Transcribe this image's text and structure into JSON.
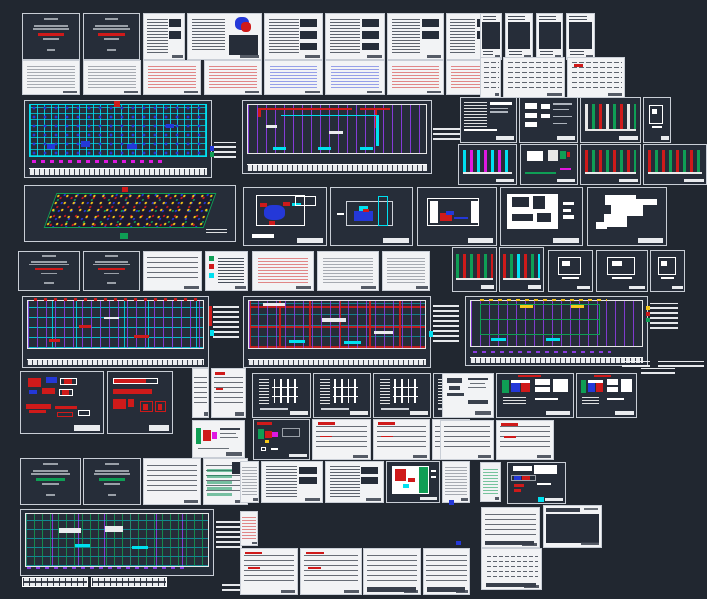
{
  "app": {
    "name": "cad-model-space",
    "canvas": {
      "width": 707,
      "height": 599
    }
  },
  "palette": {
    "bg": "#212730",
    "sheetdark": "#262d39",
    "paper": "#f2f3f5",
    "ink": "#39404c",
    "gray": "#9aa0a8",
    "red": "#cf1a1a",
    "green": "#0f9e55",
    "cyan": "#00e0f0",
    "blue": "#2438d8",
    "purple": "#8a3ce0",
    "magenta": "#e018e0",
    "yellow": "#f5c71a",
    "white": "#ffffff"
  },
  "tints": {
    "gray": "rgba(90,97,110,0.5)",
    "red": "rgba(207,26,26,0.5)",
    "blue": "rgba(36,56,216,0.45)",
    "green": "rgba(15,158,85,0.55)"
  },
  "sheets": [
    {
      "id": "cover-1",
      "x": 22,
      "y": 13,
      "w": 58,
      "h": 47,
      "type": "cover",
      "accent": "red"
    },
    {
      "id": "cover-2",
      "x": 83,
      "y": 13,
      "w": 57,
      "h": 47,
      "type": "cover",
      "accent": "red"
    },
    {
      "id": "notes-1",
      "x": 143,
      "y": 13,
      "w": 42,
      "h": 47,
      "type": "notes",
      "blocks": 2
    },
    {
      "id": "logo-sheet",
      "x": 187,
      "y": 13,
      "w": 75,
      "h": 47,
      "type": "logo"
    },
    {
      "id": "notes-2",
      "x": 264,
      "y": 13,
      "w": 59,
      "h": 47,
      "type": "notes",
      "blocks": 3
    },
    {
      "id": "notes-3",
      "x": 325,
      "y": 13,
      "w": 60,
      "h": 47,
      "type": "notes",
      "blocks": 3
    },
    {
      "id": "notes-4",
      "x": 387,
      "y": 13,
      "w": 57,
      "h": 47,
      "type": "notes",
      "blocks": 2
    },
    {
      "id": "notes-5",
      "x": 446,
      "y": 13,
      "w": 50,
      "h": 47,
      "type": "notes",
      "blocks": 2
    },
    {
      "id": "sched-1",
      "x": 480,
      "y": 13,
      "w": 22,
      "h": 47,
      "type": "narrowdark"
    },
    {
      "id": "sched-2",
      "x": 505,
      "y": 13,
      "w": 28,
      "h": 47,
      "type": "narrowdark"
    },
    {
      "id": "sched-3",
      "x": 536,
      "y": 13,
      "w": 27,
      "h": 47,
      "type": "narrowdark"
    },
    {
      "id": "sched-4",
      "x": 566,
      "y": 13,
      "w": 29,
      "h": 47,
      "type": "narrowdark"
    },
    {
      "id": "doc-1",
      "x": 22,
      "y": 60,
      "w": 58,
      "h": 35,
      "type": "doc",
      "tint": "gray"
    },
    {
      "id": "doc-2",
      "x": 83,
      "y": 60,
      "w": 58,
      "h": 35,
      "type": "doc",
      "tint": "gray"
    },
    {
      "id": "doc-3",
      "x": 143,
      "y": 60,
      "w": 58,
      "h": 35,
      "type": "doc",
      "tint": "red"
    },
    {
      "id": "doc-4",
      "x": 204,
      "y": 60,
      "w": 58,
      "h": 35,
      "type": "doc",
      "tint": "red"
    },
    {
      "id": "doc-5",
      "x": 264,
      "y": 60,
      "w": 59,
      "h": 35,
      "type": "doc",
      "tint": "blue"
    },
    {
      "id": "doc-6",
      "x": 325,
      "y": 60,
      "w": 60,
      "h": 35,
      "type": "doc",
      "tint": "blue"
    },
    {
      "id": "doc-7",
      "x": 387,
      "y": 60,
      "w": 57,
      "h": 35,
      "type": "doc",
      "tint": "red"
    },
    {
      "id": "doc-8",
      "x": 446,
      "y": 60,
      "w": 50,
      "h": 35,
      "type": "doc",
      "tint": "red"
    },
    {
      "id": "tbl-r2a",
      "x": 480,
      "y": 57,
      "w": 21,
      "h": 41,
      "type": "schedule"
    },
    {
      "id": "tbl-r2b",
      "x": 503,
      "y": 57,
      "w": 62,
      "h": 41,
      "type": "schedule"
    },
    {
      "id": "tbl-r2c",
      "x": 567,
      "y": 57,
      "w": 58,
      "h": 41,
      "type": "schedule",
      "red": true
    },
    {
      "id": "plan-ceiling",
      "x": 24,
      "y": 100,
      "w": 188,
      "h": 78,
      "type": "plan",
      "variant": "cyan"
    },
    {
      "id": "annot-plan1",
      "x": 214,
      "y": 142,
      "w": 22,
      "h": 16,
      "type": "annot"
    },
    {
      "id": "glyph-1",
      "x": 210,
      "y": 146,
      "w": 4,
      "h": 5,
      "type": "glyph",
      "color": "blue"
    },
    {
      "id": "glyph-2",
      "x": 210,
      "y": 152,
      "w": 4,
      "h": 5,
      "type": "glyph",
      "color": "green"
    },
    {
      "id": "plan-piping",
      "x": 242,
      "y": 100,
      "w": 190,
      "h": 74,
      "type": "plan",
      "variant": "purple"
    },
    {
      "id": "annot-plan2",
      "x": 433,
      "y": 128,
      "w": 28,
      "h": 12,
      "type": "annot"
    },
    {
      "id": "detail-hatch",
      "x": 460,
      "y": 97,
      "w": 57,
      "h": 46,
      "type": "detail",
      "variant": "hatch"
    },
    {
      "id": "detail-blocks",
      "x": 519,
      "y": 97,
      "w": 59,
      "h": 46,
      "type": "detail",
      "variant": "blocks"
    },
    {
      "id": "riser-1",
      "x": 580,
      "y": 97,
      "w": 61,
      "h": 46,
      "type": "riser",
      "colors": [
        "white",
        "green",
        "red"
      ]
    },
    {
      "id": "detail-box-1",
      "x": 643,
      "y": 97,
      "w": 28,
      "h": 46,
      "type": "detail",
      "variant": "smallbox"
    },
    {
      "id": "riser-2",
      "x": 458,
      "y": 144,
      "w": 59,
      "h": 41,
      "type": "riser",
      "colors": [
        "cyan",
        "magenta"
      ]
    },
    {
      "id": "detail-arrow",
      "x": 520,
      "y": 144,
      "w": 58,
      "h": 41,
      "type": "detail",
      "variant": "greenarrow"
    },
    {
      "id": "riser-3",
      "x": 580,
      "y": 144,
      "w": 61,
      "h": 41,
      "type": "riser",
      "colors": [
        "red",
        "green"
      ]
    },
    {
      "id": "riser-4",
      "x": 643,
      "y": 144,
      "w": 64,
      "h": 41,
      "type": "riser",
      "colors": [
        "red",
        "green"
      ]
    },
    {
      "id": "iso-sprinkler",
      "x": 24,
      "y": 185,
      "w": 212,
      "h": 57,
      "type": "iso"
    },
    {
      "id": "detail-pump-1",
      "x": 243,
      "y": 187,
      "w": 84,
      "h": 59,
      "type": "detail",
      "variant": "pumpblue"
    },
    {
      "id": "detail-tank-1",
      "x": 330,
      "y": 187,
      "w": 83,
      "h": 59,
      "type": "detail",
      "variant": "tank"
    },
    {
      "id": "detail-tank-2",
      "x": 417,
      "y": 187,
      "w": 80,
      "h": 59,
      "type": "detail",
      "variant": "tank2"
    },
    {
      "id": "detail-box-2",
      "x": 500,
      "y": 187,
      "w": 83,
      "h": 59,
      "type": "detail",
      "variant": "whitebox"
    },
    {
      "id": "detail-sil",
      "x": 587,
      "y": 187,
      "w": 80,
      "h": 59,
      "type": "detail",
      "variant": "silhouette"
    },
    {
      "id": "cover-3",
      "x": 18,
      "y": 251,
      "w": 62,
      "h": 40,
      "type": "cover",
      "accent": "red"
    },
    {
      "id": "cover-4",
      "x": 83,
      "y": 251,
      "w": 57,
      "h": 40,
      "type": "cover",
      "accent": "red"
    },
    {
      "id": "tbl-1",
      "x": 143,
      "y": 251,
      "w": 59,
      "h": 40,
      "type": "table"
    },
    {
      "id": "legend-1",
      "x": 205,
      "y": 251,
      "w": 43,
      "h": 40,
      "type": "legend"
    },
    {
      "id": "doc-9",
      "x": 252,
      "y": 251,
      "w": 62,
      "h": 40,
      "type": "doc",
      "tint": "red"
    },
    {
      "id": "doc-10",
      "x": 317,
      "y": 251,
      "w": 62,
      "h": 40,
      "type": "doc",
      "tint": "gray"
    },
    {
      "id": "doc-11",
      "x": 382,
      "y": 251,
      "w": 48,
      "h": 40,
      "type": "doc",
      "tint": "gray"
    },
    {
      "id": "sections-1",
      "x": 452,
      "y": 247,
      "w": 45,
      "h": 45,
      "type": "riser",
      "colors": [
        "green",
        "red"
      ]
    },
    {
      "id": "sections-2",
      "x": 499,
      "y": 247,
      "w": 45,
      "h": 45,
      "type": "riser",
      "colors": [
        "red",
        "green",
        "cyan"
      ]
    },
    {
      "id": "detail-box-3",
      "x": 548,
      "y": 250,
      "w": 45,
      "h": 42,
      "type": "detail",
      "variant": "smallbox"
    },
    {
      "id": "detail-box-4",
      "x": 596,
      "y": 250,
      "w": 52,
      "h": 42,
      "type": "detail",
      "variant": "smallbox"
    },
    {
      "id": "detail-box-5",
      "x": 650,
      "y": 250,
      "w": 35,
      "h": 42,
      "type": "detail",
      "variant": "smallbox"
    },
    {
      "id": "plan-fire",
      "x": 22,
      "y": 296,
      "w": 187,
      "h": 72,
      "type": "plan",
      "variant": "cyanred"
    },
    {
      "id": "annot-plan3",
      "x": 213,
      "y": 304,
      "w": 26,
      "h": 34,
      "type": "annot"
    },
    {
      "id": "glyph-3",
      "x": 209,
      "y": 306,
      "w": 3,
      "h": 20,
      "type": "glyph",
      "color": "red"
    },
    {
      "id": "glyph-4",
      "x": 210,
      "y": 330,
      "w": 4,
      "h": 6,
      "type": "glyph",
      "color": "cyan"
    },
    {
      "id": "plan-sprk",
      "x": 243,
      "y": 296,
      "w": 188,
      "h": 72,
      "type": "plan",
      "variant": "red"
    },
    {
      "id": "annot-plan4",
      "x": 433,
      "y": 302,
      "w": 26,
      "h": 40,
      "type": "annot"
    },
    {
      "id": "glyph-5",
      "x": 429,
      "y": 331,
      "w": 4,
      "h": 6,
      "type": "glyph",
      "color": "cyan"
    },
    {
      "id": "plan-drain",
      "x": 465,
      "y": 296,
      "w": 183,
      "h": 70,
      "type": "plan",
      "variant": "green"
    },
    {
      "id": "legend-2",
      "x": 650,
      "y": 303,
      "w": 28,
      "h": 26,
      "type": "annot"
    },
    {
      "id": "glyph-6",
      "x": 646,
      "y": 306,
      "w": 4,
      "h": 4,
      "type": "glyph",
      "color": "yellow"
    },
    {
      "id": "glyph-7",
      "x": 646,
      "y": 312,
      "w": 4,
      "h": 4,
      "type": "glyph",
      "color": "red"
    },
    {
      "id": "glyph-8",
      "x": 646,
      "y": 318,
      "w": 4,
      "h": 4,
      "type": "glyph",
      "color": "green"
    },
    {
      "id": "detail-rb",
      "x": 20,
      "y": 371,
      "w": 84,
      "h": 63,
      "type": "detail",
      "variant": "redblue"
    },
    {
      "id": "detail-rh",
      "x": 107,
      "y": 371,
      "w": 66,
      "h": 63,
      "type": "detail",
      "variant": "redhatch"
    },
    {
      "id": "tbl-2",
      "x": 192,
      "y": 368,
      "w": 17,
      "h": 50,
      "type": "table"
    },
    {
      "id": "tbl-3",
      "x": 211,
      "y": 368,
      "w": 35,
      "h": 50,
      "type": "table",
      "red": true
    },
    {
      "id": "detail-grw",
      "x": 192,
      "y": 420,
      "w": 53,
      "h": 38,
      "type": "detail",
      "variant": "greenredwhite",
      "paper": true
    },
    {
      "id": "drw-1",
      "x": 252,
      "y": 373,
      "w": 59,
      "h": 45,
      "type": "detail",
      "variant": "riserwhite"
    },
    {
      "id": "drw-2",
      "x": 313,
      "y": 373,
      "w": 58,
      "h": 45,
      "type": "detail",
      "variant": "riserwhite"
    },
    {
      "id": "drw-3",
      "x": 373,
      "y": 373,
      "w": 58,
      "h": 45,
      "type": "detail",
      "variant": "riserwhite"
    },
    {
      "id": "drw-4",
      "x": 433,
      "y": 373,
      "w": 37,
      "h": 45,
      "type": "detail",
      "variant": "riserwhite"
    },
    {
      "id": "detail-gm",
      "x": 253,
      "y": 419,
      "w": 57,
      "h": 41,
      "type": "detail",
      "variant": "greenmag"
    },
    {
      "id": "tbl-4",
      "x": 312,
      "y": 419,
      "w": 59,
      "h": 41,
      "type": "table",
      "red": true
    },
    {
      "id": "tbl-5",
      "x": 373,
      "y": 419,
      "w": 57,
      "h": 41,
      "type": "table",
      "red": true
    },
    {
      "id": "tbl-6",
      "x": 432,
      "y": 419,
      "w": 38,
      "h": 41,
      "type": "table"
    },
    {
      "id": "detail-bw",
      "x": 442,
      "y": 373,
      "w": 52,
      "h": 45,
      "type": "detail",
      "variant": "blackonwhite",
      "paper": true
    },
    {
      "id": "detail-pr1",
      "x": 496,
      "y": 373,
      "w": 78,
      "h": 45,
      "type": "detail",
      "variant": "pumpredbar"
    },
    {
      "id": "detail-pr2",
      "x": 576,
      "y": 373,
      "w": 61,
      "h": 45,
      "type": "detail",
      "variant": "pumpredbar"
    },
    {
      "id": "tbl-7",
      "x": 440,
      "y": 420,
      "w": 54,
      "h": 40,
      "type": "table"
    },
    {
      "id": "tbl-8",
      "x": 496,
      "y": 420,
      "w": 58,
      "h": 40,
      "type": "table",
      "red": true
    },
    {
      "id": "annot-1",
      "x": 622,
      "y": 361,
      "w": 28,
      "h": 6,
      "type": "annot"
    },
    {
      "id": "annot-2",
      "x": 658,
      "y": 361,
      "w": 46,
      "h": 6,
      "type": "annot"
    },
    {
      "id": "annot-3",
      "x": 641,
      "y": 368,
      "w": 34,
      "h": 6,
      "type": "annot"
    },
    {
      "id": "cover-5",
      "x": 20,
      "y": 458,
      "w": 61,
      "h": 47,
      "type": "cover",
      "accent": "green"
    },
    {
      "id": "cover-6",
      "x": 83,
      "y": 458,
      "w": 58,
      "h": 47,
      "type": "cover",
      "accent": "green"
    },
    {
      "id": "tbl-9",
      "x": 143,
      "y": 458,
      "w": 58,
      "h": 47,
      "type": "table"
    },
    {
      "id": "tbl-10",
      "x": 203,
      "y": 458,
      "w": 45,
      "h": 47,
      "type": "table",
      "green": true
    },
    {
      "id": "doc-12",
      "x": 240,
      "y": 461,
      "w": 19,
      "h": 42,
      "type": "doc",
      "tint": "gray"
    },
    {
      "id": "notes-6",
      "x": 261,
      "y": 461,
      "w": 62,
      "h": 42,
      "type": "notes",
      "blocks": 2
    },
    {
      "id": "notes-7",
      "x": 325,
      "y": 461,
      "w": 59,
      "h": 42,
      "type": "notes",
      "blocks": 2
    },
    {
      "id": "detail-gb",
      "x": 386,
      "y": 461,
      "w": 54,
      "h": 42,
      "type": "detail",
      "variant": "greenblock"
    },
    {
      "id": "doc-13",
      "x": 442,
      "y": 461,
      "w": 28,
      "h": 42,
      "type": "doc",
      "tint": "gray"
    },
    {
      "id": "doc-14",
      "x": 480,
      "y": 462,
      "w": 21,
      "h": 40,
      "type": "doc",
      "tint": "green"
    },
    {
      "id": "detail-pg",
      "x": 507,
      "y": 462,
      "w": 59,
      "h": 42,
      "type": "detail",
      "variant": "pumpgray"
    },
    {
      "id": "plan-base",
      "x": 20,
      "y": 509,
      "w": 194,
      "h": 67,
      "type": "plan",
      "variant": "greenplan"
    },
    {
      "id": "dim-1",
      "x": 22,
      "y": 577,
      "w": 66,
      "h": 10,
      "type": "dimstrip"
    },
    {
      "id": "dim-2",
      "x": 91,
      "y": 577,
      "w": 76,
      "h": 10,
      "type": "dimstrip"
    },
    {
      "id": "annot-4",
      "x": 216,
      "y": 518,
      "w": 26,
      "h": 30,
      "type": "annot"
    },
    {
      "id": "annot-5",
      "x": 222,
      "y": 583,
      "w": 20,
      "h": 8,
      "type": "annot"
    },
    {
      "id": "doc-15",
      "x": 240,
      "y": 511,
      "w": 18,
      "h": 35,
      "type": "doc",
      "tint": "red"
    },
    {
      "id": "tbl-11",
      "x": 240,
      "y": 548,
      "w": 58,
      "h": 47,
      "type": "table",
      "red": true
    },
    {
      "id": "tbl-12",
      "x": 300,
      "y": 548,
      "w": 62,
      "h": 47,
      "type": "table",
      "red": true
    },
    {
      "id": "tbl-13",
      "x": 363,
      "y": 548,
      "w": 58,
      "h": 47,
      "type": "table",
      "footer": true
    },
    {
      "id": "tbl-14",
      "x": 423,
      "y": 548,
      "w": 47,
      "h": 47,
      "type": "table",
      "footer": true
    },
    {
      "id": "tbl-15",
      "x": 481,
      "y": 507,
      "w": 59,
      "h": 41,
      "type": "table",
      "footer": true
    },
    {
      "id": "detail-da",
      "x": 543,
      "y": 505,
      "w": 59,
      "h": 43,
      "type": "detail",
      "variant": "darkarea",
      "paper": true
    },
    {
      "id": "tbl-16",
      "x": 481,
      "y": 548,
      "w": 61,
      "h": 42,
      "type": "table",
      "dotted": true,
      "footer": true
    },
    {
      "id": "glyph-9",
      "x": 449,
      "y": 500,
      "w": 5,
      "h": 5,
      "type": "glyph",
      "color": "blue"
    },
    {
      "id": "glyph-10",
      "x": 456,
      "y": 541,
      "w": 5,
      "h": 4,
      "type": "glyph",
      "color": "blue"
    },
    {
      "id": "glyph-11",
      "x": 538,
      "y": 497,
      "w": 6,
      "h": 5,
      "type": "glyph",
      "color": "cyan"
    }
  ]
}
